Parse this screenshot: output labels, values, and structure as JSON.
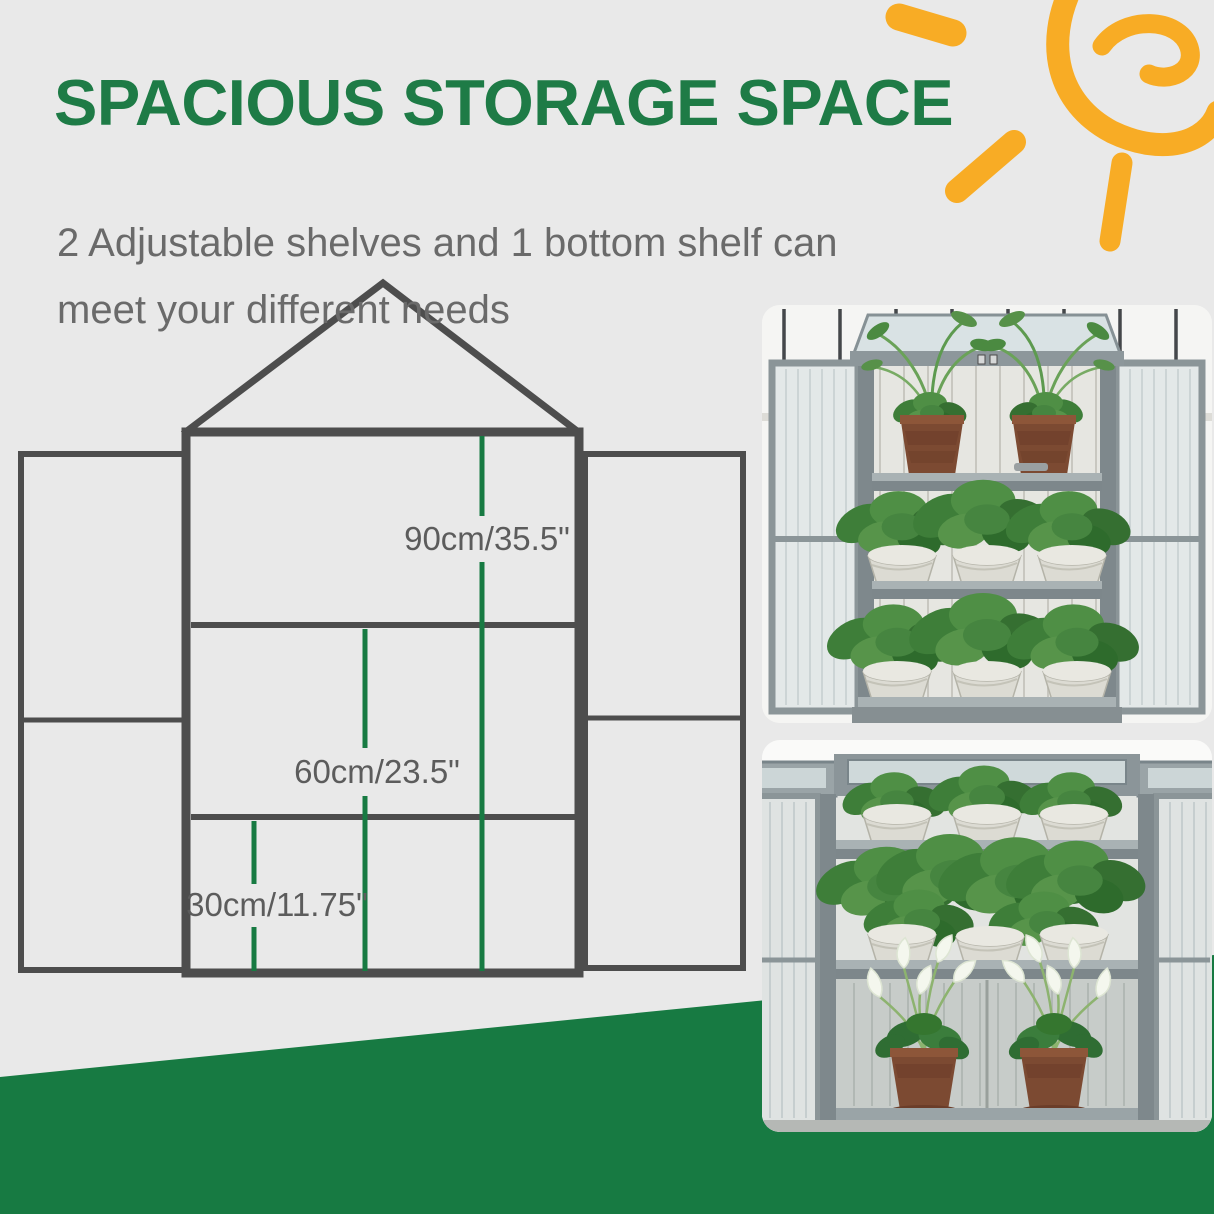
{
  "page": {
    "background": "#e9e9e9"
  },
  "header": {
    "title": "SPACIOUS STORAGE SPACE",
    "subtitle_lines": [
      "2 Adjustable shelves and 1 bottom shelf can",
      "meet your different needs"
    ]
  },
  "diagram": {
    "measurements": [
      {
        "cm": 90,
        "inches": 35.5,
        "label": "90cm/35.5\""
      },
      {
        "cm": 60,
        "inches": 23.5,
        "label": "60cm/23.5\""
      },
      {
        "cm": 30,
        "inches": 11.75,
        "label": "30cm/11.75\""
      }
    ]
  },
  "colors": {
    "title_green": "#1e7b46",
    "accent_green": "#177a42",
    "outline_gray": "#4d4d4d",
    "label_gray": "#5c5c5c",
    "subtitle_gray": "#6a6a6a",
    "sun_orange": "#f8ac25"
  }
}
